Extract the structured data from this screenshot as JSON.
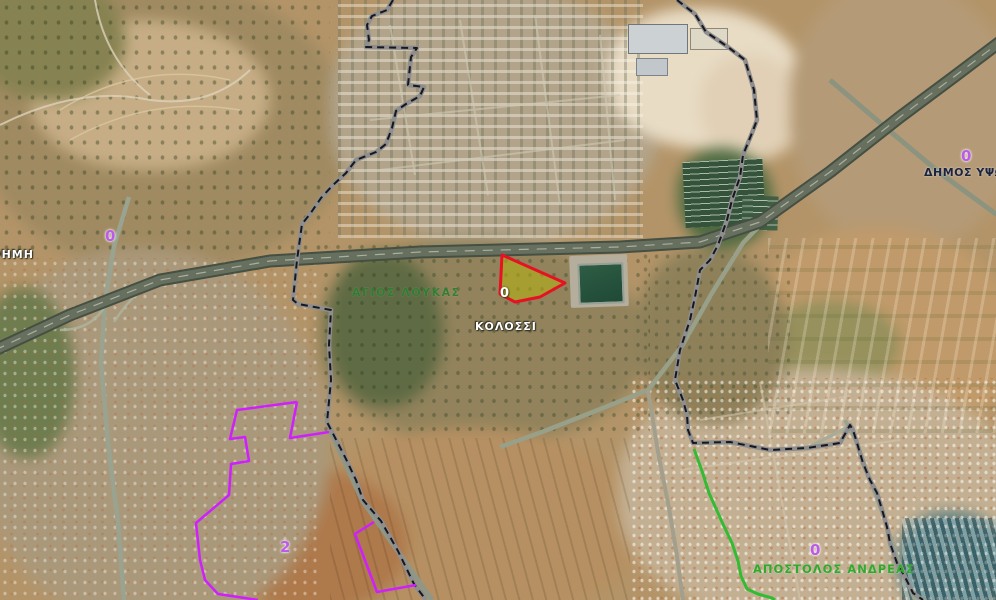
{
  "map": {
    "type": "aerial-cadastral-map",
    "village_labels": [
      {
        "text": "ΕΡΗΜΗ",
        "color": "#ffffff"
      },
      {
        "text": "ΚΟΛΟΣΣΙ",
        "color": "#ffffff"
      }
    ],
    "quarter_labels": [
      {
        "text": "ΑΓΙΟΣ ΛΟΥΚΑΣ",
        "color": "#2e7d32"
      },
      {
        "text": "ΑΠΟΣΤΟΛΟΣ ΑΝΔΡΕΑΣ",
        "color": "#2eab2e"
      }
    ],
    "municipality_label": {
      "text": "ΔΗΜΟΣ ΥΨΩ",
      "color": "#1c2340"
    },
    "plot_numbers": {
      "motorway_west": "0",
      "northeast": "0",
      "southwest": "2",
      "southeast": "0"
    },
    "selected_parcel": {
      "number": "0",
      "outline_color": "#e81123",
      "fill_color": "#b8b40e"
    },
    "overlay_colors": {
      "municipal_boundary_dash": "#16161f",
      "municipal_boundary_casing": "#8e8e8e",
      "zone_boundary_magenta": "#cf1fff",
      "zone_boundary_green": "#33bb33",
      "plot_number_purple": "#bb5ce8"
    }
  }
}
